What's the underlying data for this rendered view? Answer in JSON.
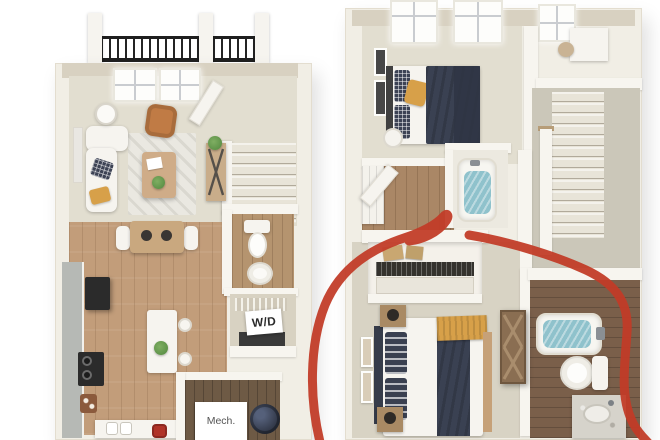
{
  "image": {
    "type": "3d-floor-plan-rendering",
    "description": "Side-by-side 3D floor plans of a two-story townhome; first floor on the left (balcony, living room, dining, kitchen, half bath, W/D closet, mechanical room, stairs), second floor on the right (two bedrooms, two bathrooms, hall closet, stairwell); a hand-drawn red circle highlights the rear second-floor bedroom and its bathroom"
  },
  "labels": {
    "washer_dryer": "W/D",
    "mechanical": "Mech."
  },
  "floorplans": [
    {
      "id": "first-floor",
      "side": "left",
      "rooms": [
        "balcony",
        "living-room",
        "dining-area",
        "kitchen",
        "half-bath",
        "laundry-closet",
        "mechanical-room",
        "stairs",
        "entry"
      ]
    },
    {
      "id": "second-floor",
      "side": "right",
      "rooms": [
        "front-bedroom",
        "desk-nook",
        "hallway",
        "hall-bathroom",
        "stairwell",
        "rear-bedroom",
        "rear-bathroom",
        "closet"
      ]
    }
  ],
  "annotation": {
    "shape": "hand-drawn-circle",
    "color": "#c13b27",
    "target": "second-floor rear bedroom and rear bathroom"
  },
  "colors": {
    "paper": "#ffffff",
    "wall": "#f1eee5",
    "wall-face": "#f7f5ef",
    "wall-top": "#d8d1c1",
    "carpet": "#e2ded0",
    "carpet-2": "#d8d3c4",
    "wood": "#c29d7a",
    "wood-hall": "#aa8766",
    "wood-dark": "#7a5f4a",
    "wood-mech": "#6e5a45",
    "counter": "#b6b9b5",
    "appliance": "#2b2b2b",
    "white-obj": "#f6f4ef",
    "navy": "#3a4152",
    "navy-deep": "#2f3544",
    "mustard": "#d7a049",
    "cognac": "#c07b45",
    "water": "#8fc2cc",
    "plant": "#5f9349",
    "rug": "#eae8e1",
    "stair": "#e8e4d8",
    "label-ink": "#2a2a2a",
    "mech-ink": "#555555",
    "annotation": "#c13b27"
  }
}
